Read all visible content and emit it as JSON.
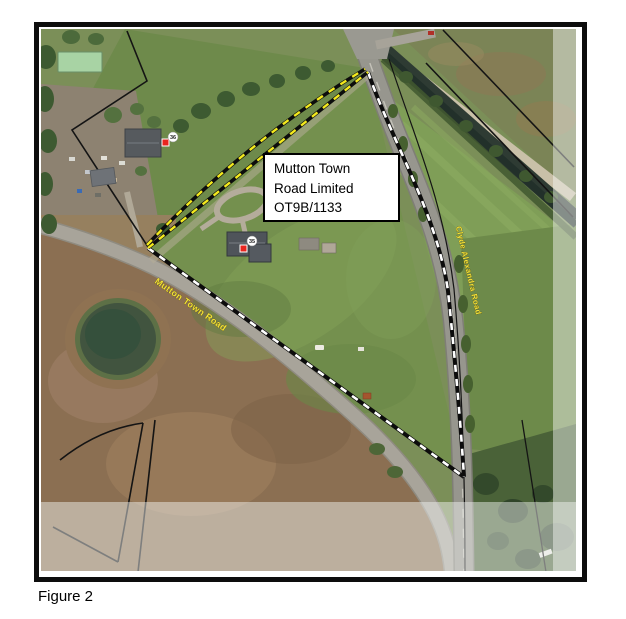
{
  "figure": {
    "caption": "Figure 2"
  },
  "map": {
    "label_box": {
      "line1": "Mutton Town",
      "line2": "Road Limited",
      "line3": "OT9B/1133"
    },
    "road_labels": {
      "mutton_town": "Mutton Town Road",
      "clyde_alexandra": "Clyde Alexandra Road"
    },
    "markers": {
      "house_35": "35",
      "house_36": "36"
    },
    "colors": {
      "parcel_dash_yellow": "#f4ea1c",
      "parcel_dash_white": "#ffffff",
      "parcel_dash_base": "#0c0c0c",
      "marker_red": "#e8251f",
      "frame_border": "#0d0d0d"
    }
  }
}
